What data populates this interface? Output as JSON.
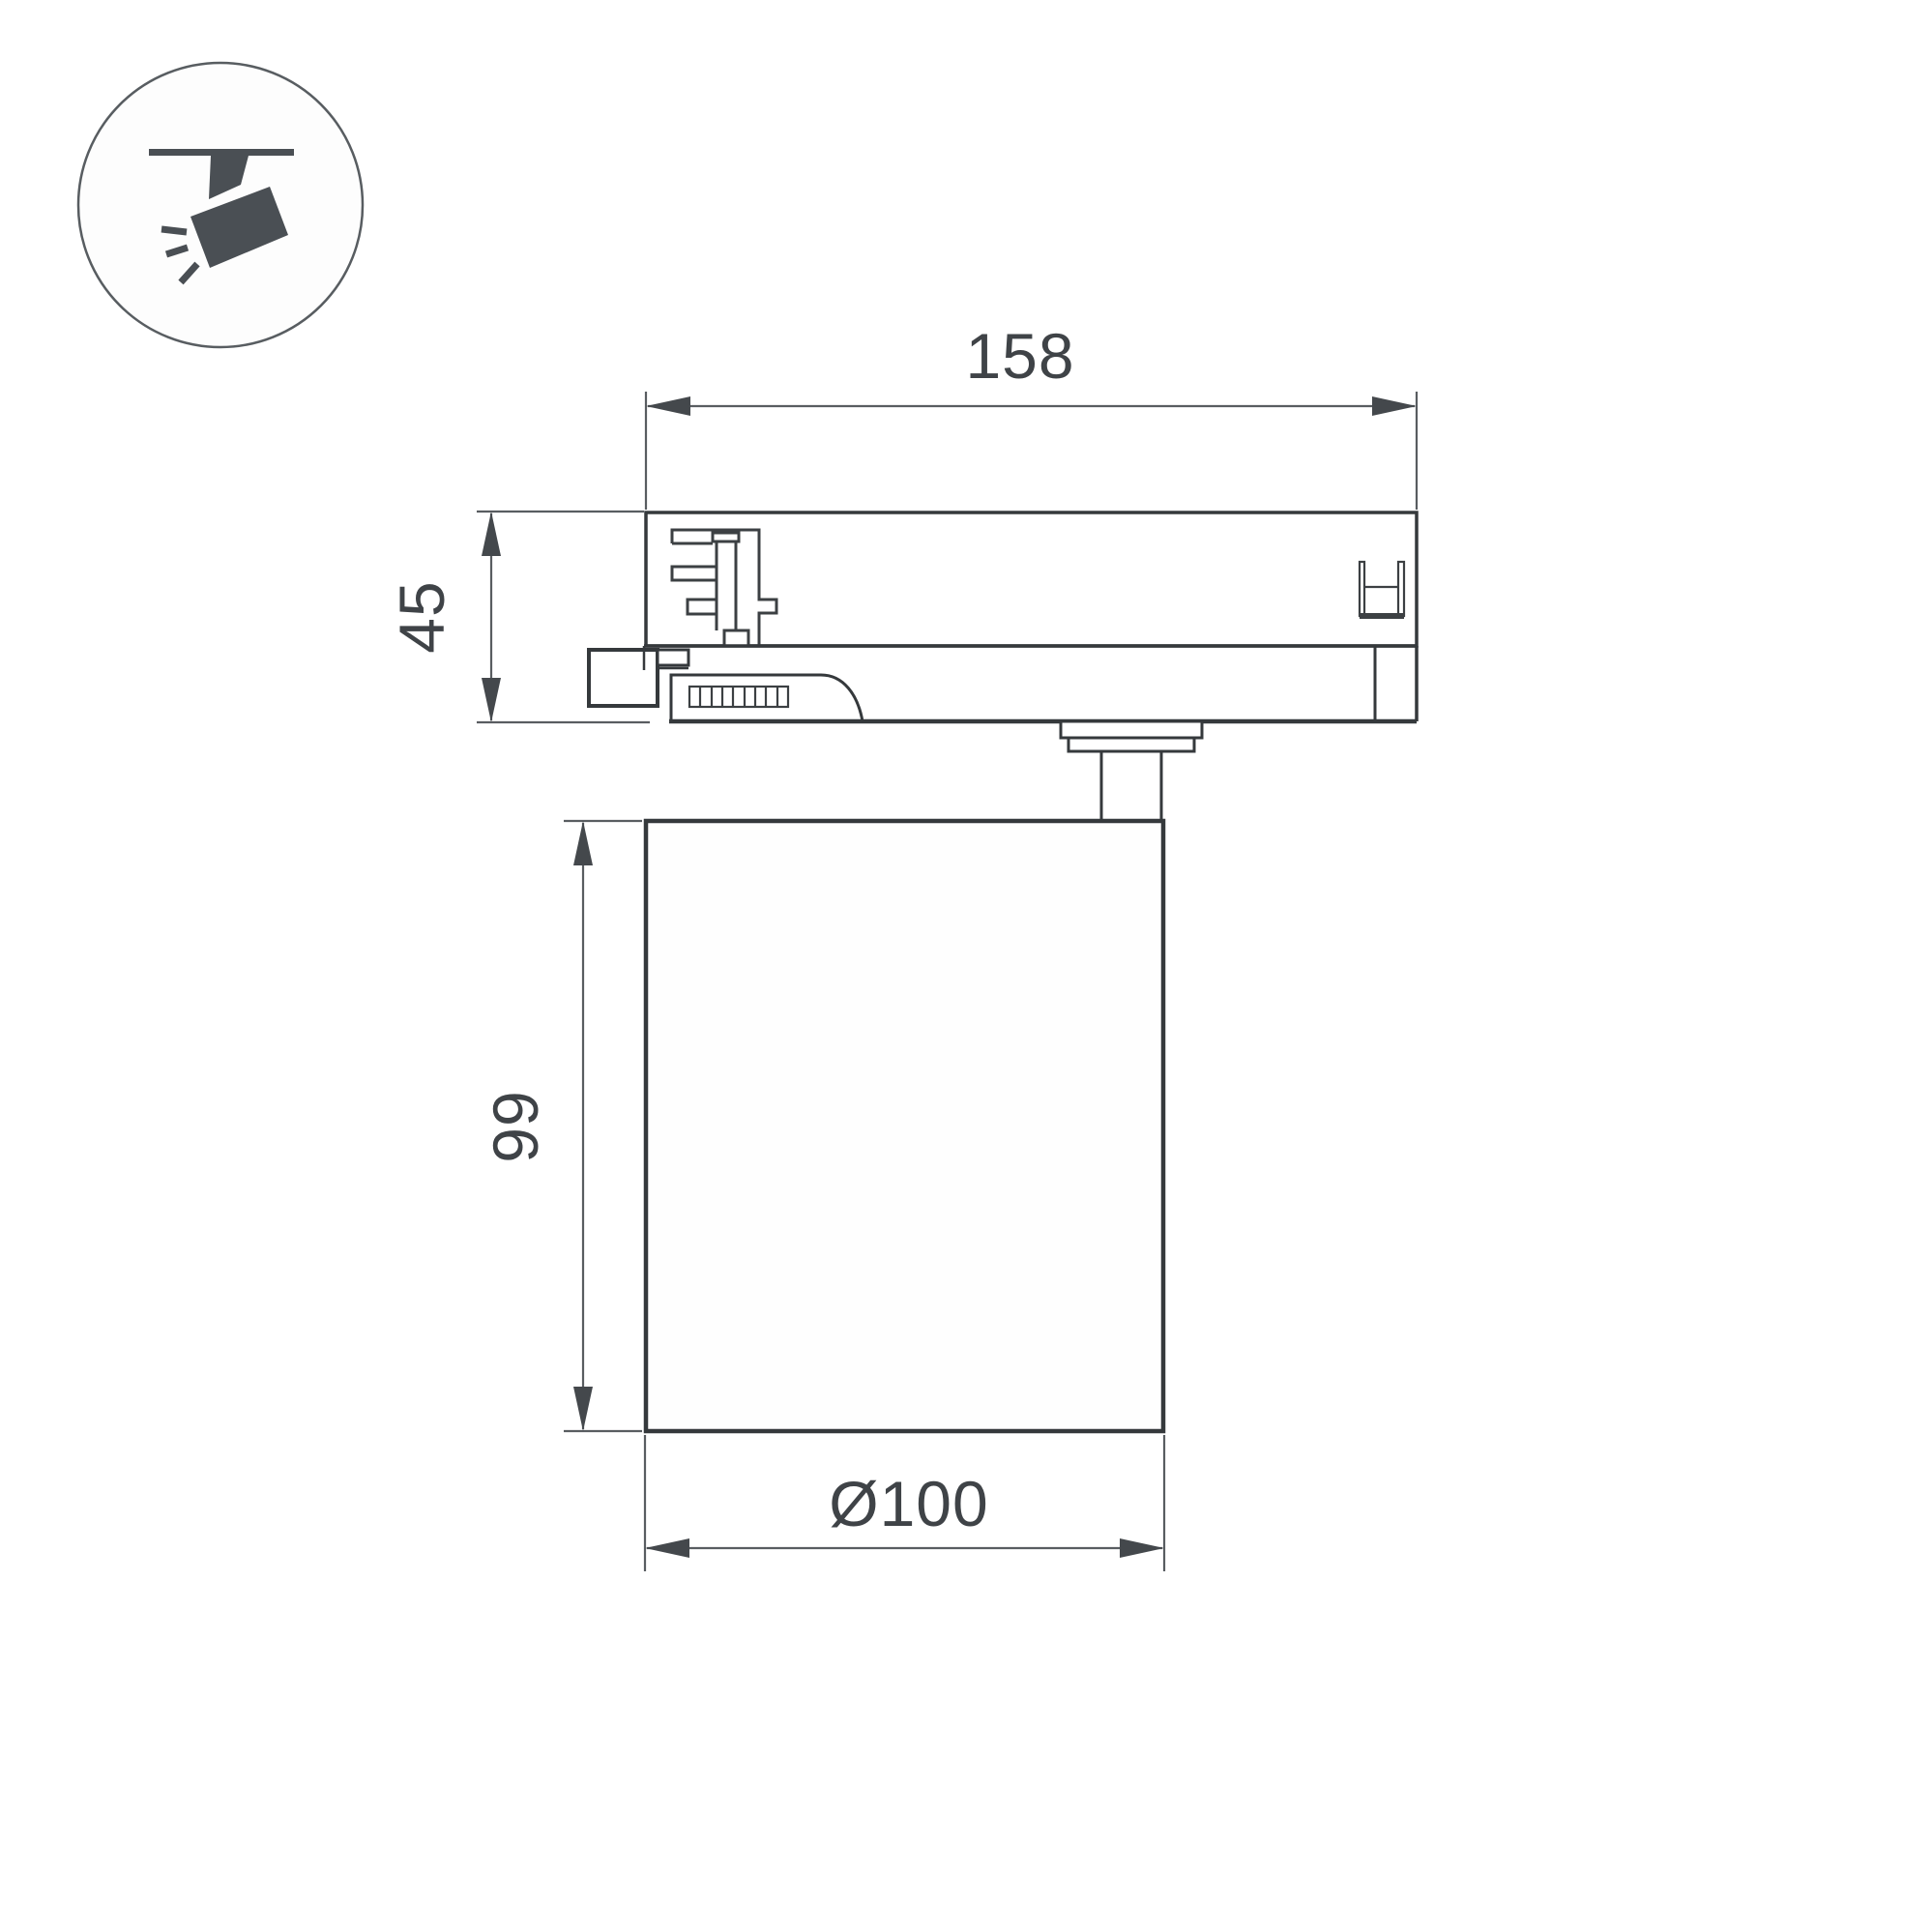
{
  "icons": {
    "badge": "track-spotlight-icon"
  },
  "dimensions": {
    "width": "158",
    "adapter_height": "45",
    "body_height": "99",
    "diameter": "Ø100"
  },
  "colors": {
    "background": "#ffffff",
    "body_outline": "#35393c",
    "detail_line": "#3c4043",
    "dimension_line": "#595d61",
    "label_text": "#3f4347",
    "icon_fill": "#4a4f54",
    "icon_circle_stroke": "#585d61"
  }
}
